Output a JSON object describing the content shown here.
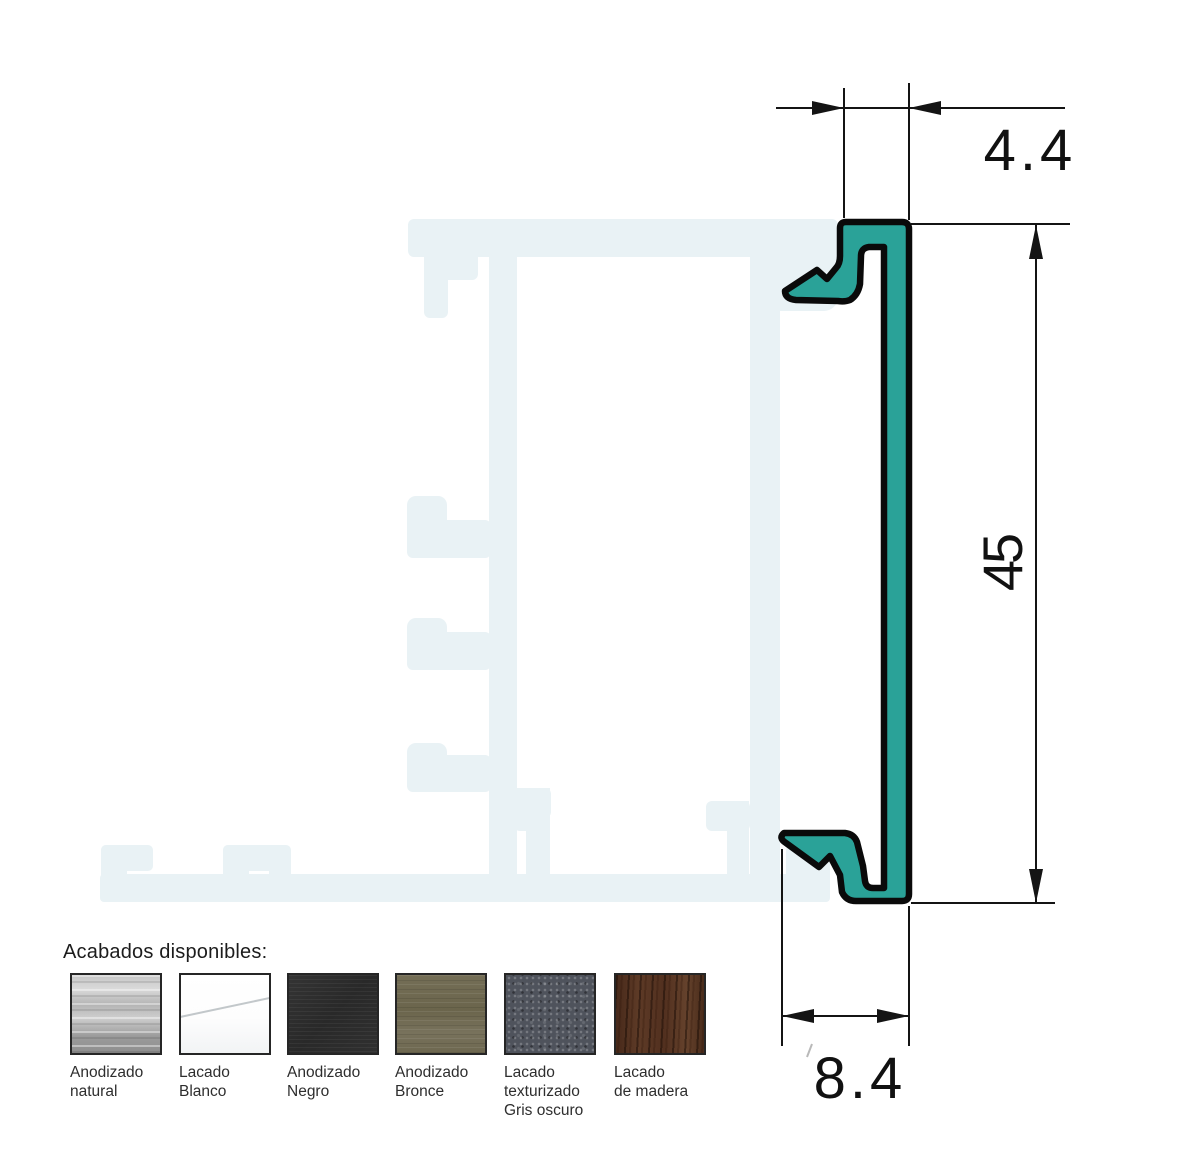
{
  "drawing": {
    "title_semantic": "aluminium cover profile cross-section",
    "dimensions": {
      "top_width": "4.4",
      "height": "45",
      "bottom_width": "8.4"
    },
    "colors": {
      "profile_fill": "#2aa298",
      "profile_outline": "#0a0a0a",
      "ghost_profile": "#e9f2f5",
      "dimension_lines": "#141414"
    }
  },
  "finishes": {
    "title": "Acabados disponibles:",
    "items": [
      {
        "label": "Anodizado natural",
        "lines": [
          "Anodizado",
          "natural",
          ""
        ],
        "texture": "brushed-silver",
        "base_color": "#aeaeae"
      },
      {
        "label": "Lacado Blanco",
        "lines": [
          "Lacado",
          "Blanco",
          ""
        ],
        "texture": "glossy-white",
        "base_color": "#ffffff"
      },
      {
        "label": "Anodizado Negro",
        "lines": [
          "Anodizado",
          "Negro",
          ""
        ],
        "texture": "matte-black",
        "base_color": "#2d2d2d"
      },
      {
        "label": "Anodizado Bronce",
        "lines": [
          "Anodizado",
          "Bronce",
          ""
        ],
        "texture": "bronze",
        "base_color": "#6c664d"
      },
      {
        "label": "Lacado texturizado Gris oscuro",
        "lines": [
          "Lacado",
          "texturizado",
          "Gris oscuro"
        ],
        "texture": "textured-dark-gray",
        "base_color": "#4f535c"
      },
      {
        "label": "Lacado de madera",
        "lines": [
          "Lacado",
          "de madera",
          ""
        ],
        "texture": "dark-wood",
        "base_color": "#5a392a"
      }
    ]
  }
}
